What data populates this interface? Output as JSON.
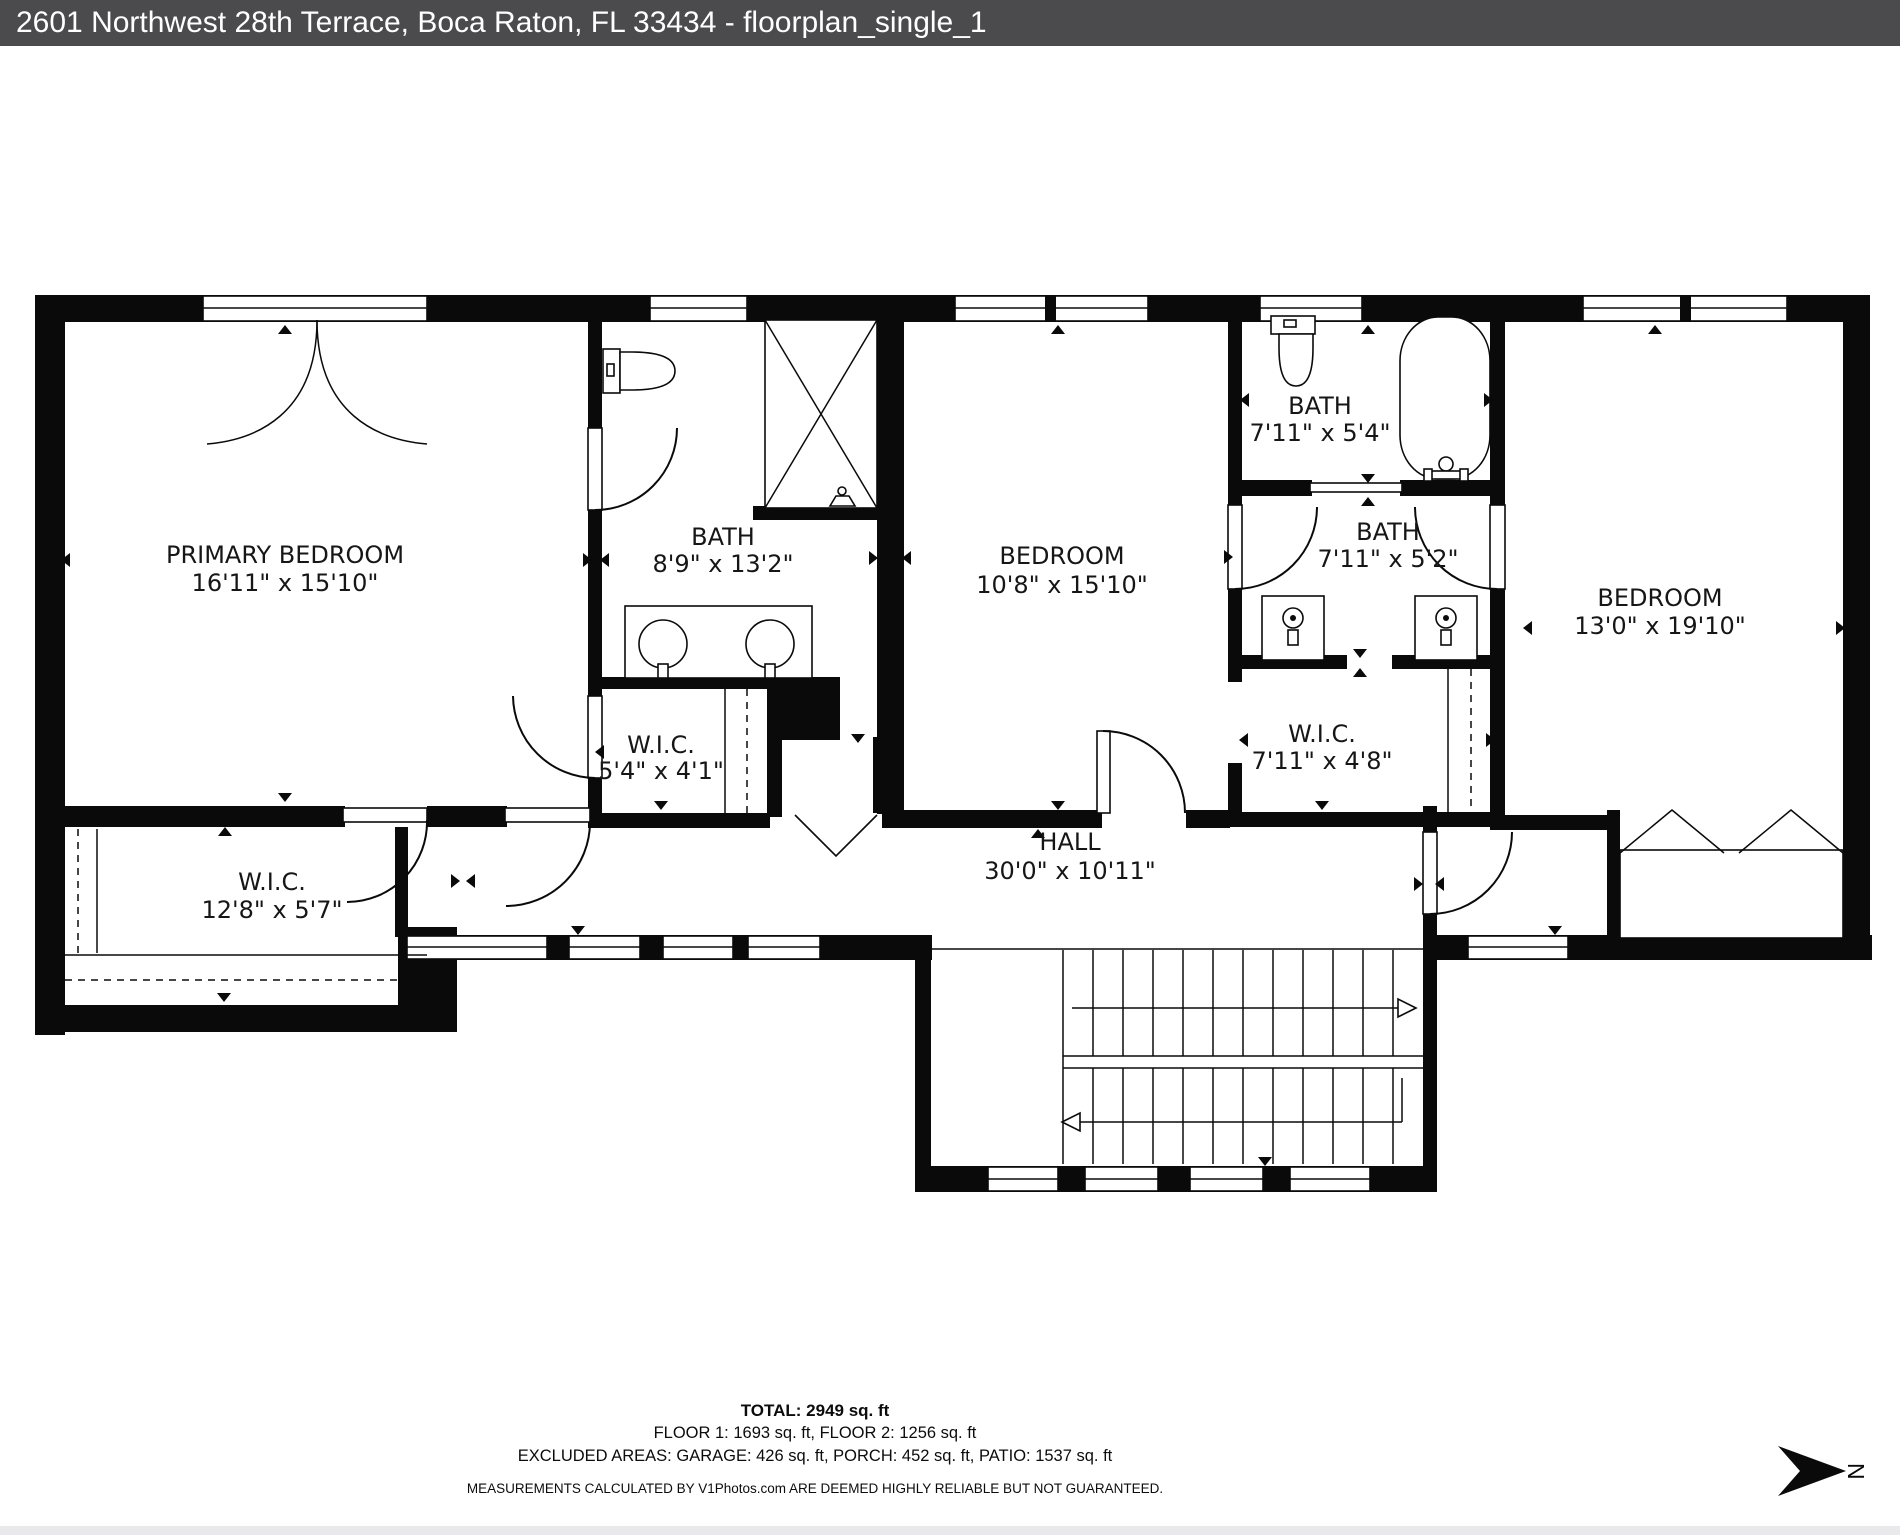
{
  "header": {
    "title": "2601 Northwest 28th Terrace, Boca Raton, FL 33434 - floorplan_single_1"
  },
  "floorplan": {
    "rooms": [
      {
        "id": "primary-bedroom",
        "name": "PRIMARY BEDROOM",
        "dims": "16'11\" x 15'10\""
      },
      {
        "id": "bath-primary",
        "name": "BATH",
        "dims": "8'9\" x 13'2\""
      },
      {
        "id": "bedroom-middle",
        "name": "BEDROOM",
        "dims": "10'8\" x 15'10\""
      },
      {
        "id": "bath-upper",
        "name": "BATH",
        "dims": "7'11\" x 5'4\""
      },
      {
        "id": "bath-lower",
        "name": "BATH",
        "dims": "7'11\" x 5'2\""
      },
      {
        "id": "bedroom-right",
        "name": "BEDROOM",
        "dims": "13'0\" x 19'10\""
      },
      {
        "id": "wic-primary",
        "name": "W.I.C.",
        "dims": "5'4\" x 4'1\""
      },
      {
        "id": "wic-middle",
        "name": "W.I.C.",
        "dims": "7'11\" x 4'8\""
      },
      {
        "id": "wic-left",
        "name": "W.I.C.",
        "dims": "12'8\" x 5'7\""
      },
      {
        "id": "hall",
        "name": "HALL",
        "dims": "30'0\" x 10'11\""
      }
    ],
    "compass": {
      "label": "N"
    }
  },
  "footer": {
    "total": "TOTAL: 2949 sq. ft",
    "floors": "FLOOR 1: 1693 sq. ft, FLOOR 2: 1256 sq. ft",
    "excluded": "EXCLUDED AREAS: GARAGE: 426 sq. ft, PORCH: 452 sq. ft, PATIO: 1537 sq. ft",
    "disclaimer": "MEASUREMENTS CALCULATED BY V1Photos.com ARE DEEMED HIGHLY RELIABLE BUT NOT GUARANTEED."
  }
}
